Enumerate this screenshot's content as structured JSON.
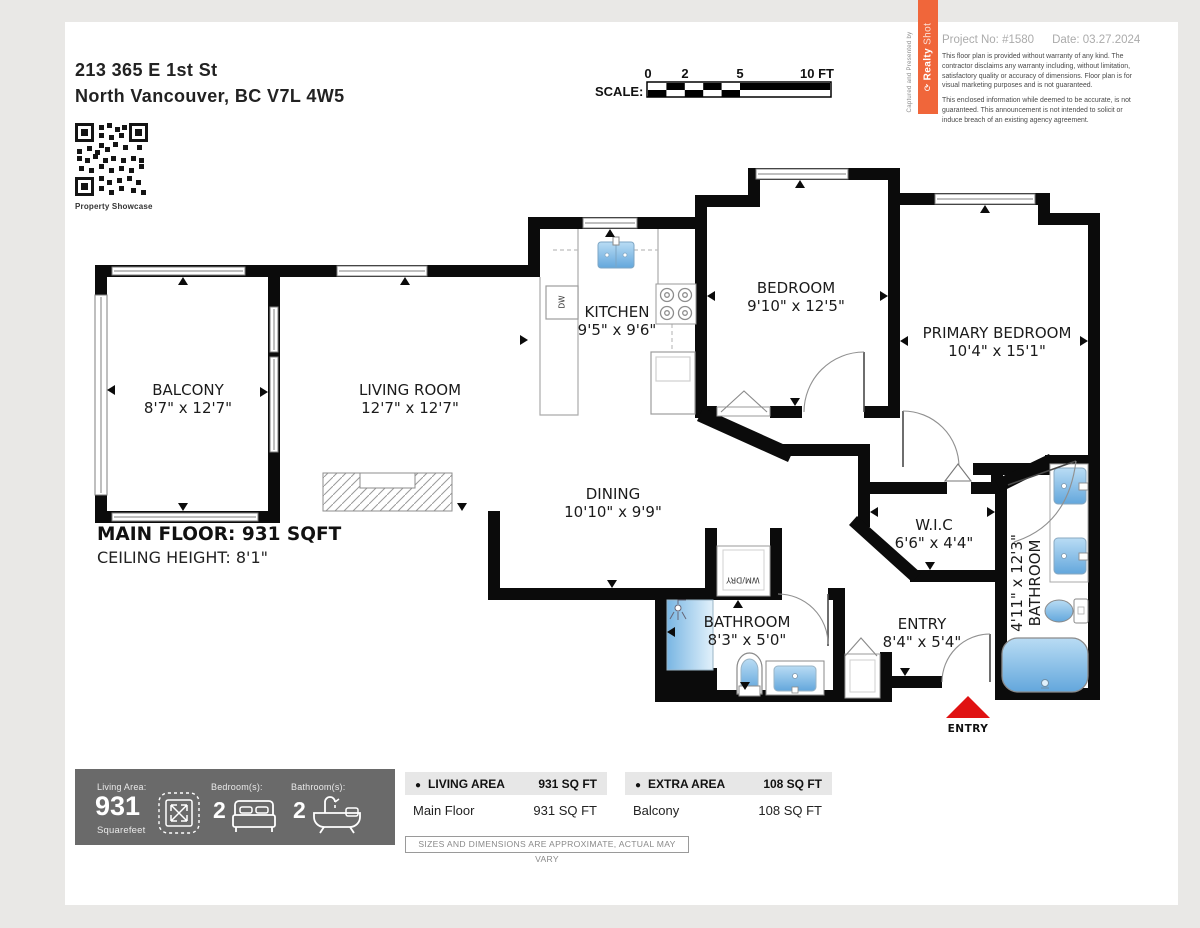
{
  "header": {
    "address_line1": "213 365 E 1st St",
    "address_line2": "North Vancouver, BC V7L 4W5",
    "qr_caption": "Property Showcase",
    "scale": {
      "label": "SCALE:",
      "t0": "0",
      "t2": "2",
      "t5": "5",
      "t10": "10 FT"
    },
    "branding": {
      "vertical_caption": "Captured and Presented by",
      "logo_realty": "Realty",
      "logo_shot": "Shot",
      "accent_color": "#f0663a"
    },
    "project_no": "Project No: #1580",
    "date": "Date: 03.27.2024",
    "disclaimer1": "This floor plan is provided without warranty of any kind. The contractor disclaims any warranty including, without limitation, satisfactory quality or accuracy of dimensions. Floor plan is for visual marketing purposes and is not guaranteed.",
    "disclaimer2": "This enclosed information while deemed to be accurate, is not guaranteed. This announcement is not intended to solicit or induce breach of an existing agency agreement."
  },
  "floorplan": {
    "main_floor_label": "MAIN FLOOR: 931 SQFT",
    "ceiling_label": "CEILING HEIGHT: 8'1\"",
    "entry_marker": "ENTRY",
    "entry_arrow_color": "#e01212",
    "rooms": {
      "balcony": {
        "name": "BALCONY",
        "dims": "8'7\" x 12'7\""
      },
      "living": {
        "name": "LIVING ROOM",
        "dims": "12'7\" x 12'7\""
      },
      "kitchen": {
        "name": "KITCHEN",
        "dims": "9'5\" x 9'6\""
      },
      "bedroom": {
        "name": "BEDROOM",
        "dims": "9'10\" x 12'5\""
      },
      "primary": {
        "name": "PRIMARY BEDROOM",
        "dims": "10'4\" x 15'1\""
      },
      "dining": {
        "name": "DINING",
        "dims": "10'10\" x 9'9\""
      },
      "wic": {
        "name": "W.I.C",
        "dims": "6'6\" x 4'4\""
      },
      "entry": {
        "name": "ENTRY",
        "dims": "8'4\" x 5'4\""
      },
      "bath_main": {
        "name": "BATHROOM",
        "dims": "8'3\" x 5'0\""
      },
      "bath_ens": {
        "name": "BATHROOM",
        "dims": "4'11\" x 12'3\""
      }
    },
    "fixtures": {
      "dishwasher": "DW",
      "washer_dryer": "WM/DRY"
    }
  },
  "footer": {
    "summary": {
      "living_area_label": "Living Area:",
      "living_area_value": "931",
      "living_area_unit": "Squarefeet",
      "bedrooms_label": "Bedroom(s):",
      "bedrooms_value": "2",
      "bathrooms_label": "Bathroom(s):",
      "bathrooms_value": "2"
    },
    "living_table": {
      "header": "LIVING AREA",
      "header_value": "931 SQ FT",
      "rows": [
        {
          "label": "Main Floor",
          "value": "931 SQ FT"
        }
      ]
    },
    "extra_table": {
      "header": "EXTRA AREA",
      "header_value": "108 SQ FT",
      "rows": [
        {
          "label": "Balcony",
          "value": "108 SQ FT"
        }
      ]
    },
    "note": "SIZES AND DIMENSIONS ARE APPROXIMATE, ACTUAL MAY VARY"
  }
}
